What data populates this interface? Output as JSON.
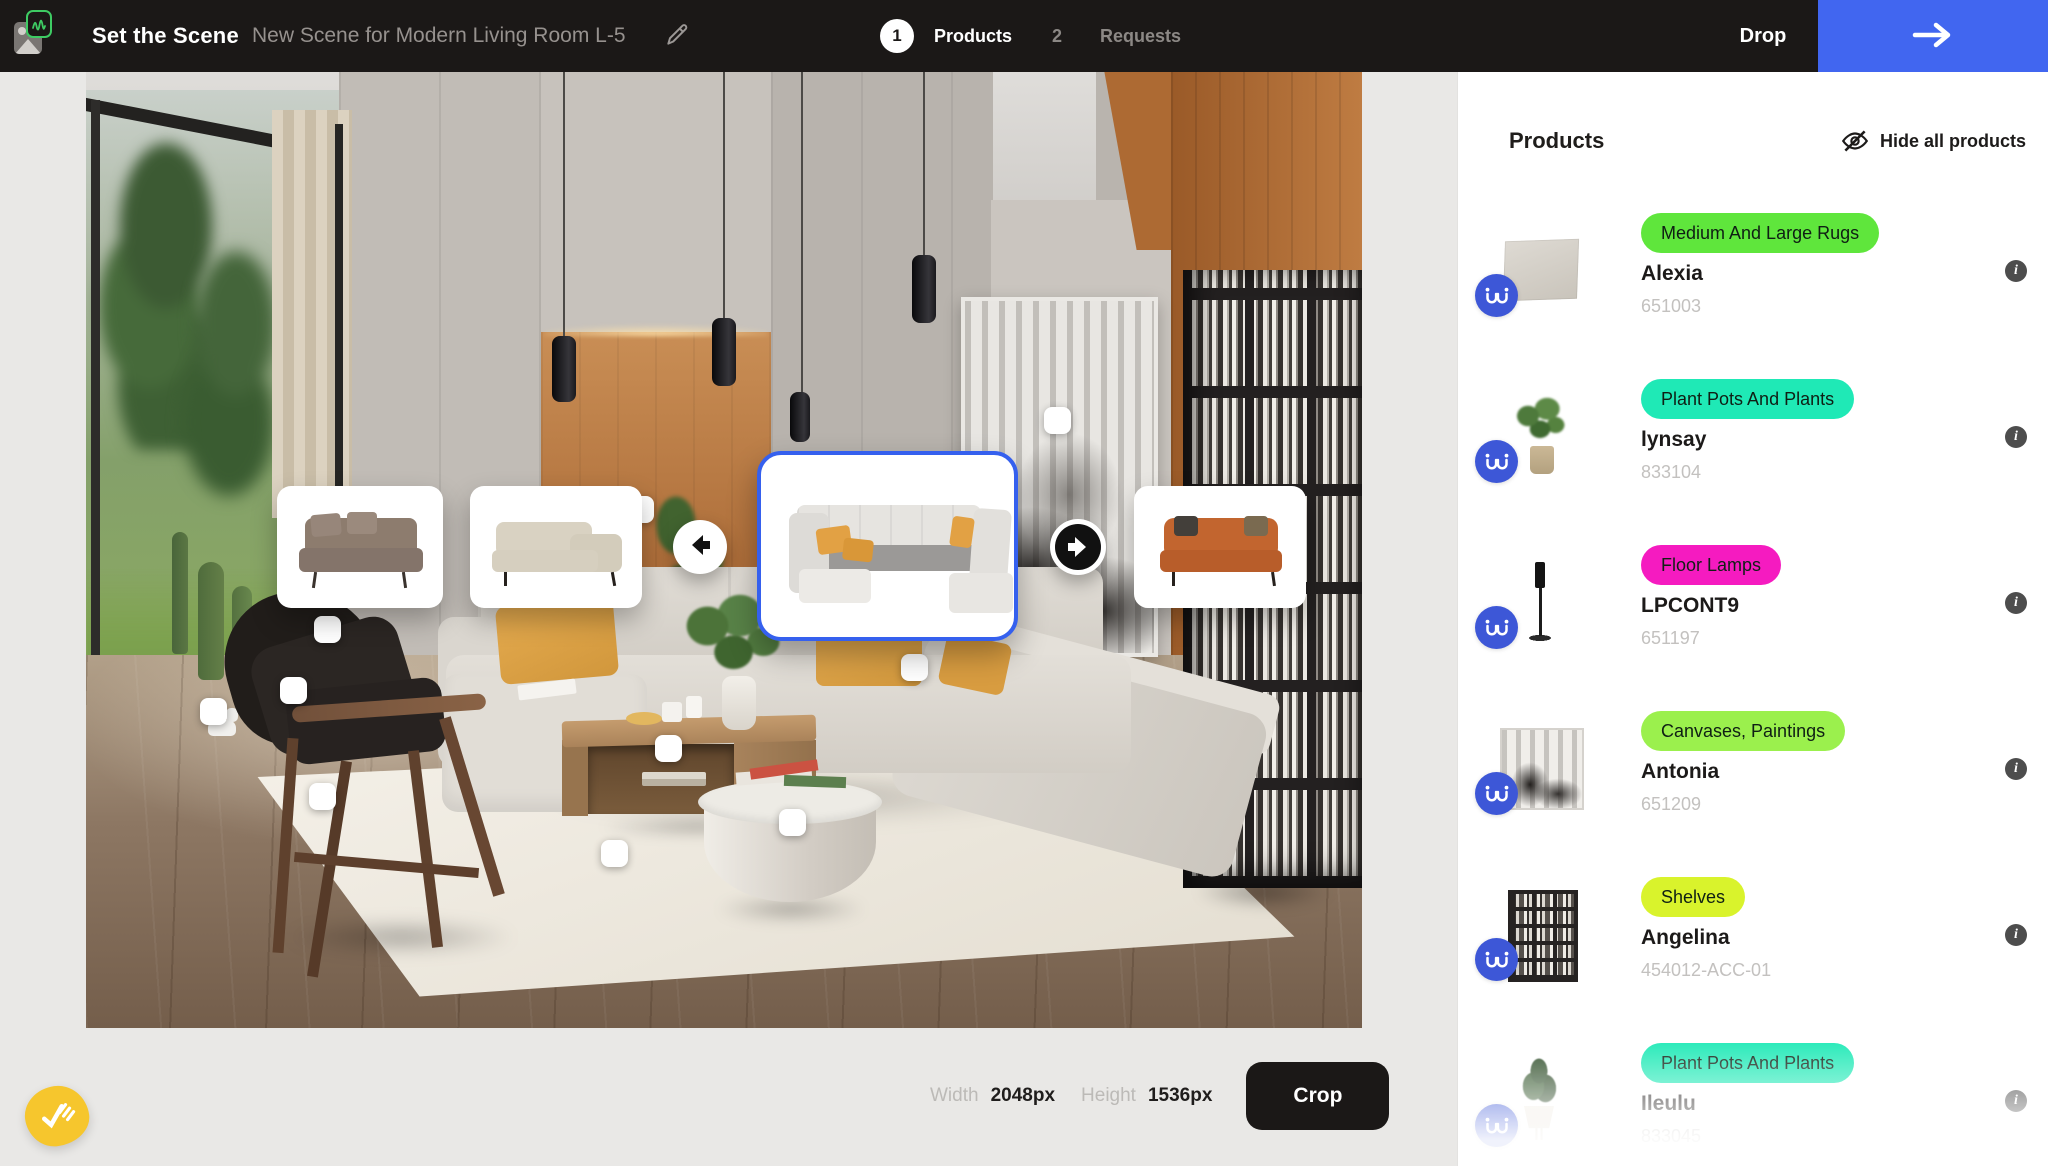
{
  "header": {
    "app_title": "Set the Scene",
    "scene_name": "New Scene for Modern Living Room L-5",
    "step1_number": "1",
    "step1_label": "Products",
    "step2_number": "2",
    "step2_label": "Requests",
    "drop_label": "Drop"
  },
  "panel": {
    "title": "Products",
    "hide_all_label": "Hide all products",
    "items": [
      {
        "category": "Medium And Large Rugs",
        "category_color": "#5fe63c",
        "name": "Alexia",
        "sku": "651003",
        "thumb": "rug"
      },
      {
        "category": "Plant Pots And Plants",
        "category_color": "#1fe9b6",
        "name": "lynsay",
        "sku": "833104",
        "thumb": "plant"
      },
      {
        "category": "Floor Lamps",
        "category_color": "#f51bc0",
        "name": "LPCONT9",
        "sku": "651197",
        "thumb": "floor-lamp"
      },
      {
        "category": "Canvases, Paintings",
        "category_color": "#9bf04d",
        "name": "Antonia",
        "sku": "651209",
        "thumb": "painting"
      },
      {
        "category": "Shelves",
        "category_color": "#d9f32c",
        "name": "Angelina",
        "sku": "454012-ACC-01",
        "thumb": "shelf"
      },
      {
        "category": "Plant Pots And Plants",
        "category_color": "#1fe9b6",
        "name": "Ileulu",
        "sku": "833045",
        "thumb": "plant"
      }
    ]
  },
  "footer": {
    "width_label": "Width",
    "width_value": "2048px",
    "height_label": "Height",
    "height_value": "1536px",
    "crop_label": "Crop"
  },
  "carousel": {
    "selected_index": 2,
    "variants": [
      "brown-fabric-sofa",
      "beige-corner-sofa",
      "light-gray-u-sectional",
      "orange-sofa"
    ]
  },
  "info_icon_glyph": "i",
  "colors": {
    "accent_blue": "#4166f0",
    "selected_border_blue": "#3560ee",
    "brand_circle_blue": "#3d57d7",
    "usersnap_yellow": "#f6c62d",
    "header_dark": "#1b1817"
  }
}
